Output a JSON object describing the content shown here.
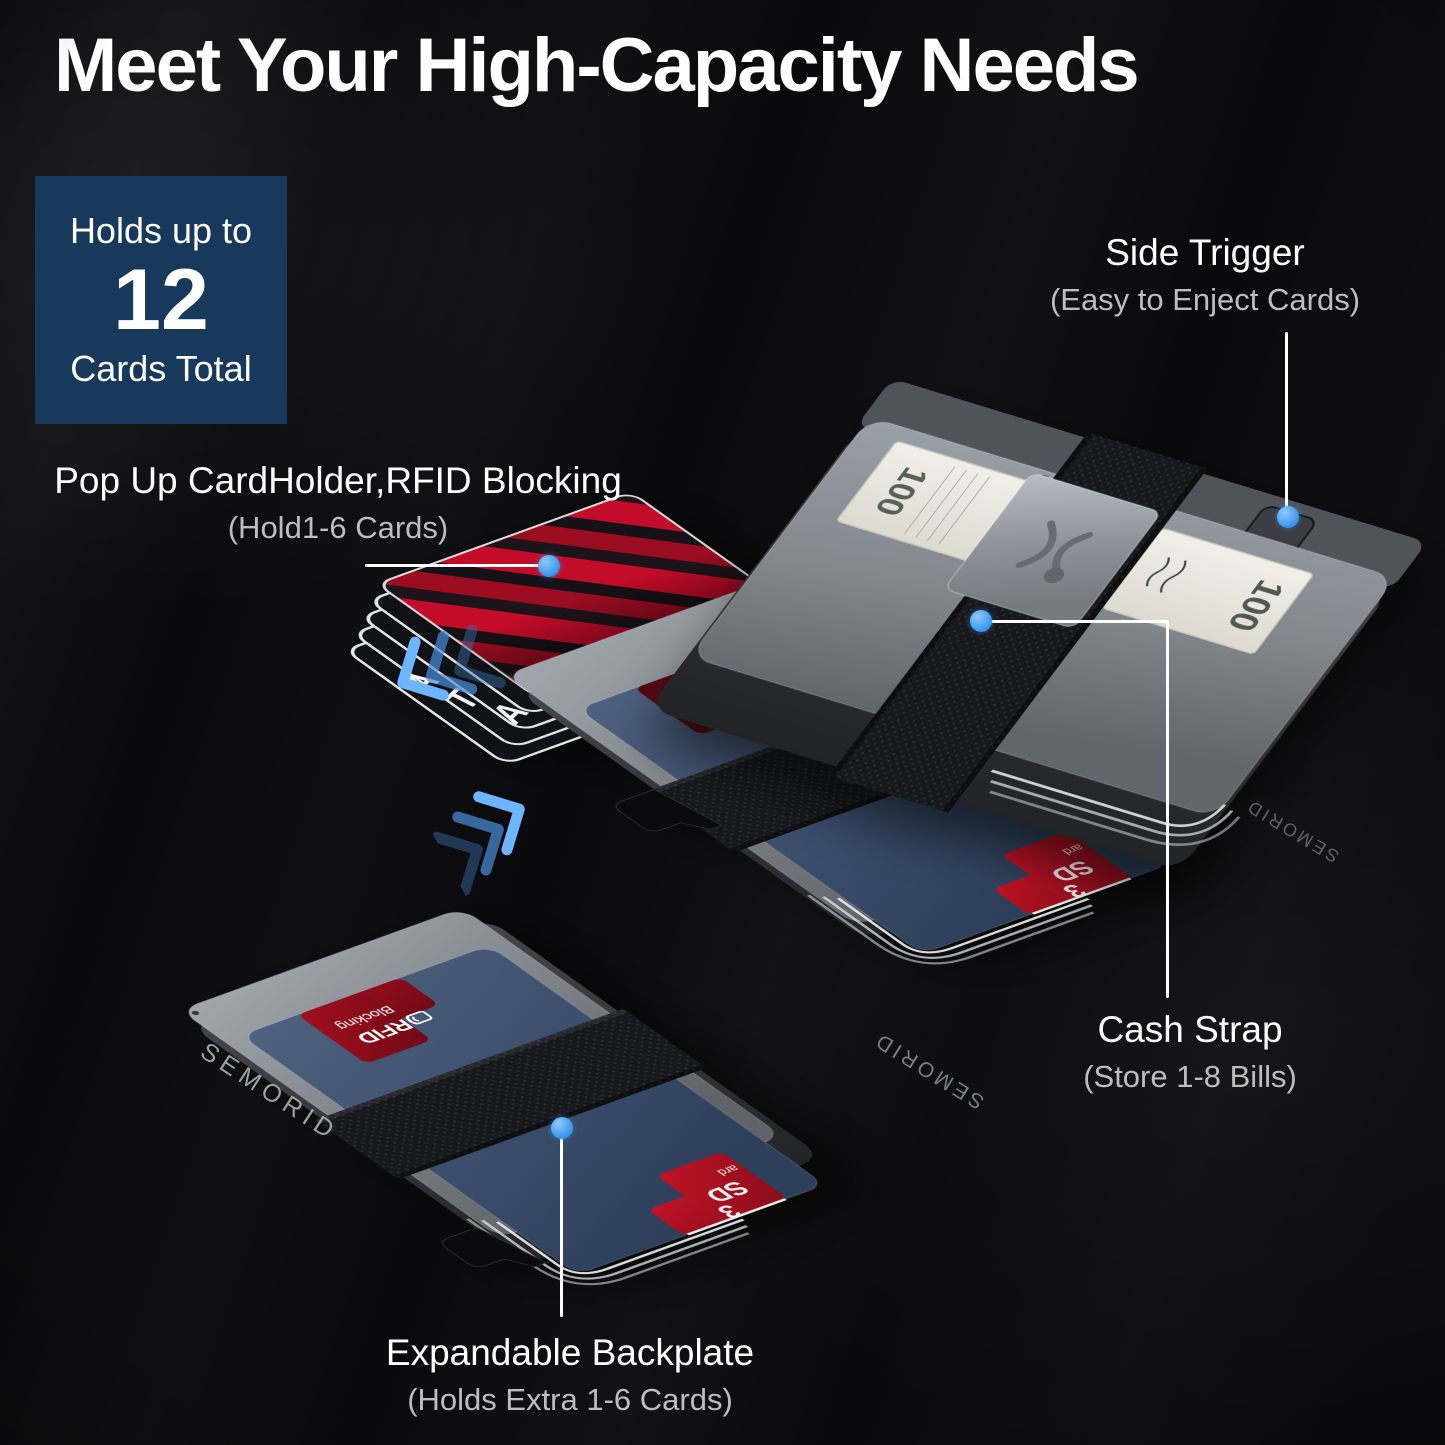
{
  "title": "Meet Your High-Capacity Needs",
  "capacity_badge": {
    "line1": "Holds up to",
    "number": "12",
    "line2": "Cards Total"
  },
  "callouts": {
    "pop_up": {
      "label": "Pop Up CardHolder,RFID Blocking",
      "sub": "(Hold1-6 Cards)"
    },
    "side_trigger": {
      "label": "Side Trigger",
      "sub": "(Easy to Enject Cards)"
    },
    "cash_strap": {
      "label": "Cash Strap",
      "sub": "(Store 1-8 Bills)"
    },
    "expandable_backplate": {
      "label": "Expandable Backplate",
      "sub": "(Holds Extra 1-6 Cards)"
    }
  },
  "product": {
    "brand": "SEMORID",
    "rfid_card": {
      "line1": "RFID",
      "line2": "Blocking"
    },
    "sd_card": {
      "word_fragment": "ard",
      "abbr": "SD",
      "digit": "3"
    },
    "bill": {
      "denomination": "100",
      "legend": "FEDERAL RESERVE NOTE"
    },
    "popped_card_letters": [
      "A",
      "T",
      "A"
    ]
  },
  "colors": {
    "background": "#0A0A0C",
    "badge_bg": "#17395C",
    "accent_dot": "#3E9BEF",
    "label_text": "#FFFFFF",
    "sub_text": "#BDBDBD",
    "card_red": "#C00B28",
    "plate_navy": "#3B4E6C",
    "case_gray": "#7E8289"
  },
  "icons": [
    "brand-logo-icon",
    "rfid-contactless-icon",
    "pop-direction-chevrons-icon",
    "expand-direction-chevrons-icon"
  ]
}
